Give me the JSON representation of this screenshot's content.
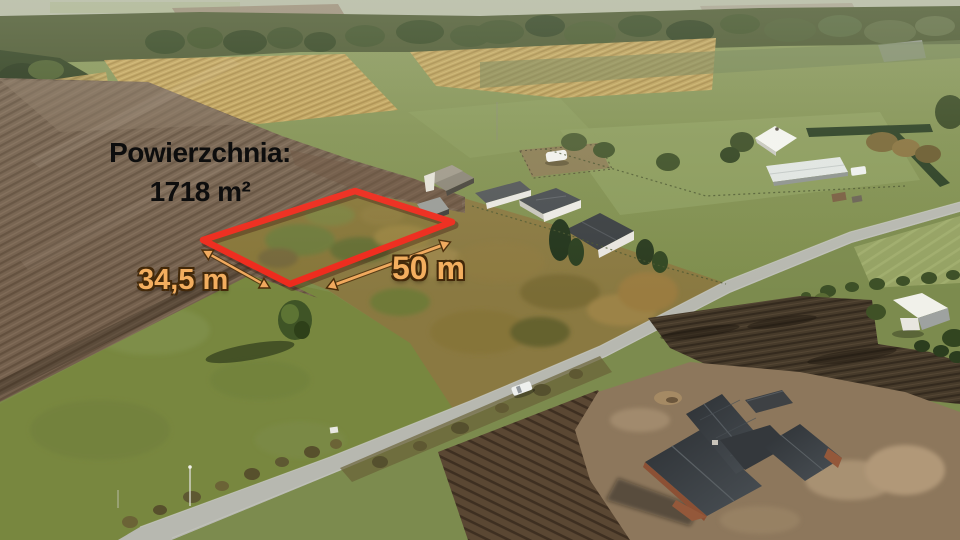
{
  "overlay": {
    "area_label": "Powierzchnia:",
    "area_value": "1718 m²",
    "width_label": "34,5 m",
    "length_label": "50 m"
  },
  "colors": {
    "plot_outline": "#ee2a1c",
    "dimension_arrows": "#f0a85c",
    "dimension_text": "#f3ae5f",
    "area_text": "#0d0d0d"
  }
}
